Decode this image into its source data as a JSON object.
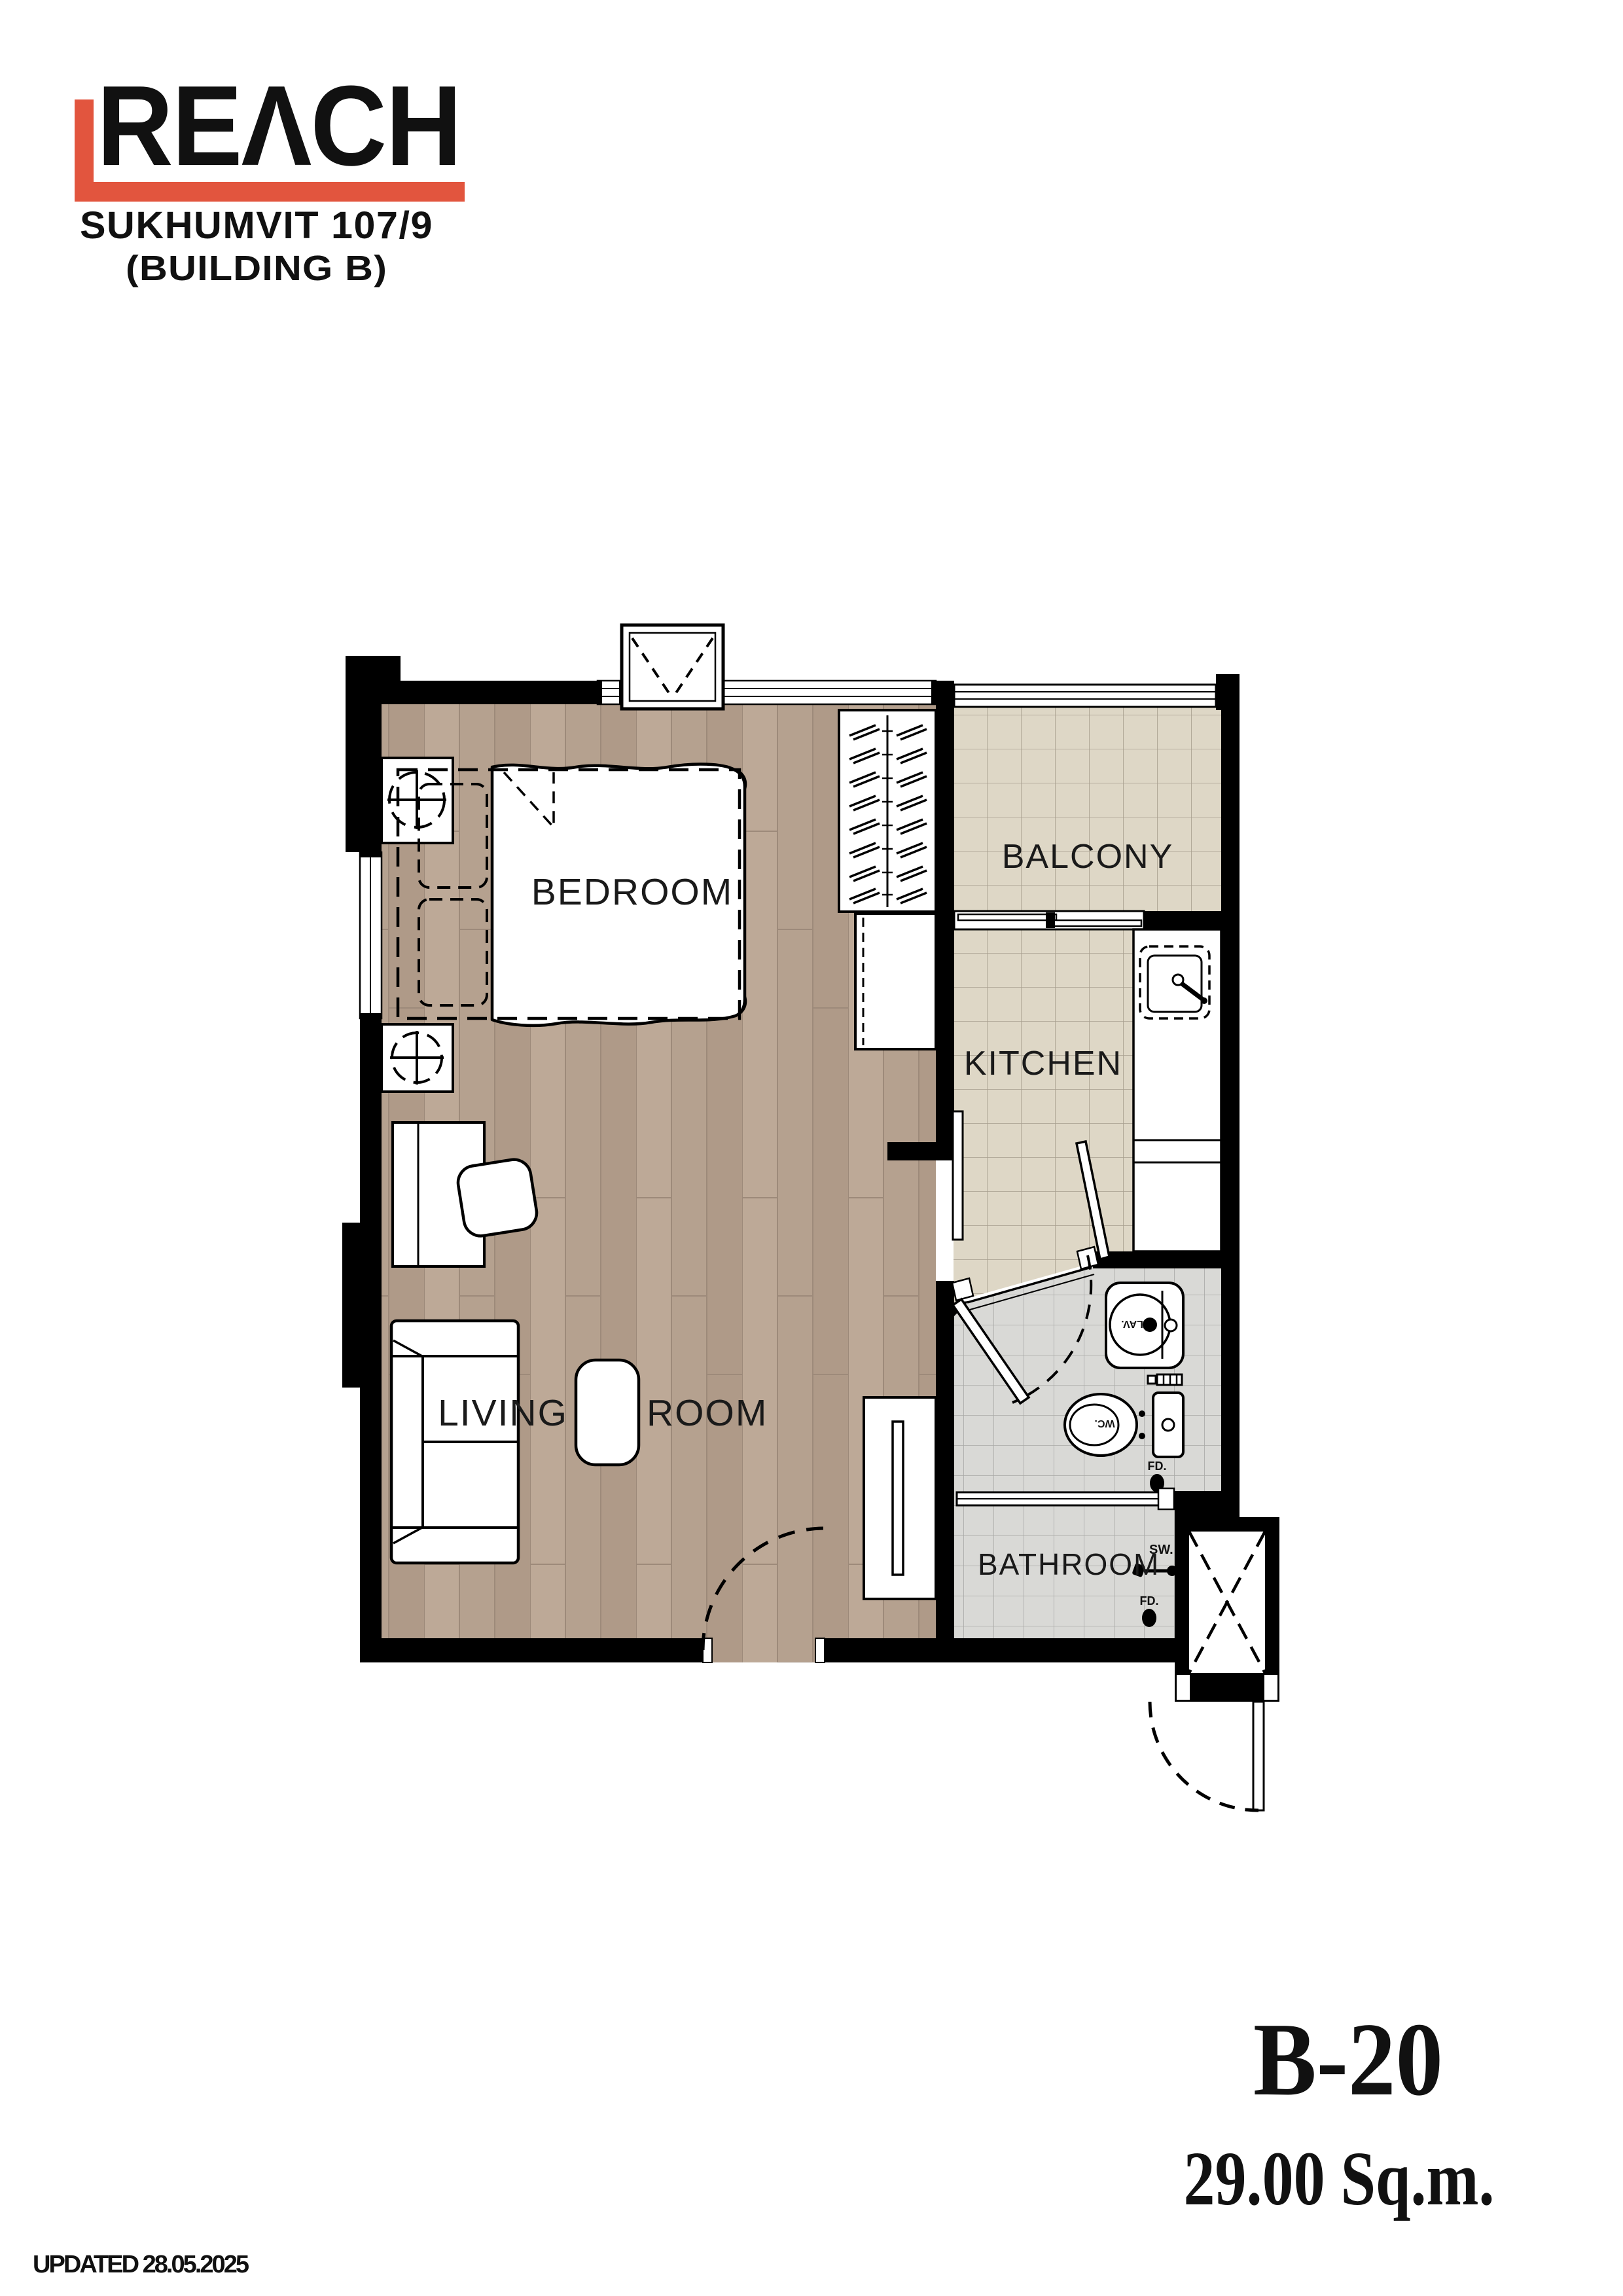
{
  "header": {
    "logo_text": "REΛCH",
    "logo_color": "#e2553e",
    "project_name": "SUKHUMVIT 107/9",
    "building_name": "(BUILDING B)"
  },
  "floor_plan": {
    "rooms": {
      "bedroom": "BEDROOM",
      "balcony": "BALCONY",
      "kitchen": "KITCHEN",
      "living_word1": "LIVING",
      "living_word2": "ROOM",
      "bathroom": "BATHROOM"
    },
    "fixture_labels": {
      "shower": "SW.",
      "lavatory": "LAV.",
      "water_closet": "WC.",
      "floor_drain_1": "FD.",
      "floor_drain_2": "FD."
    },
    "colors": {
      "wall": "#000000",
      "wood_floor": "#b5a18f",
      "balcony_tile": "#ded7c6",
      "bathroom_tile": "#d9d9d6"
    }
  },
  "unit_info": {
    "unit_number": "B-20",
    "unit_area": "29.00 Sq.m."
  },
  "footer": {
    "updated_text": "UPDATED 28.05.2025"
  }
}
